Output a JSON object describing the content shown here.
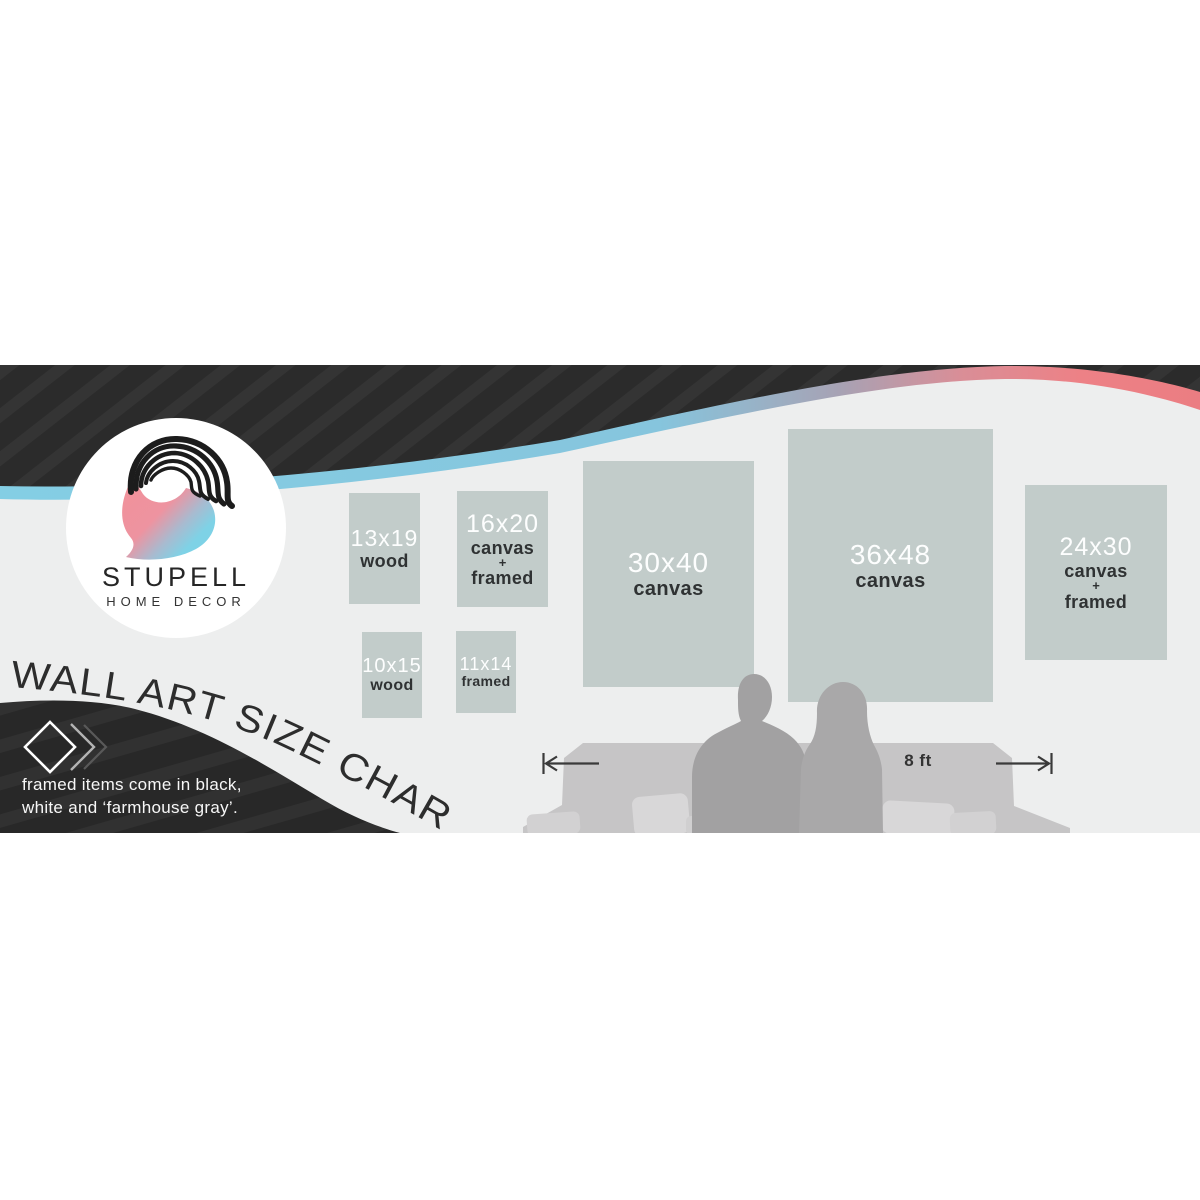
{
  "brand": {
    "name": "STUPELL",
    "tagline": "HOME DECOR"
  },
  "title": "WALL ART SIZE CHART",
  "footnote": {
    "line1": "framed items come in black,",
    "line2": "white and ‘farmhouse gray’."
  },
  "room": {
    "measurement_label": "8 ft"
  },
  "sizes": [
    {
      "size": "13x19",
      "materials": {
        "line1": "wood"
      }
    },
    {
      "size": "16x20",
      "materials": {
        "line1": "canvas",
        "line2": "+",
        "line3": "framed"
      }
    },
    {
      "size": "10x15",
      "materials": {
        "line1": "wood"
      }
    },
    {
      "size": "11x14",
      "materials": {
        "line1": "framed"
      }
    },
    {
      "size": "30x40",
      "materials": {
        "line1": "canvas"
      }
    },
    {
      "size": "36x48",
      "materials": {
        "line1": "canvas"
      }
    },
    {
      "size": "24x30",
      "materials": {
        "line1": "canvas",
        "line2": "+",
        "line3": "framed"
      }
    }
  ],
  "colors": {
    "background": "#edeeee",
    "wave_black": "#2b2b2b",
    "accent_blue": "#84cee4",
    "accent_coral": "#ec8186",
    "panel_gray": "#c2ccca",
    "logo_pink": "#ef8d96",
    "logo_blue": "#7ed2e6"
  }
}
